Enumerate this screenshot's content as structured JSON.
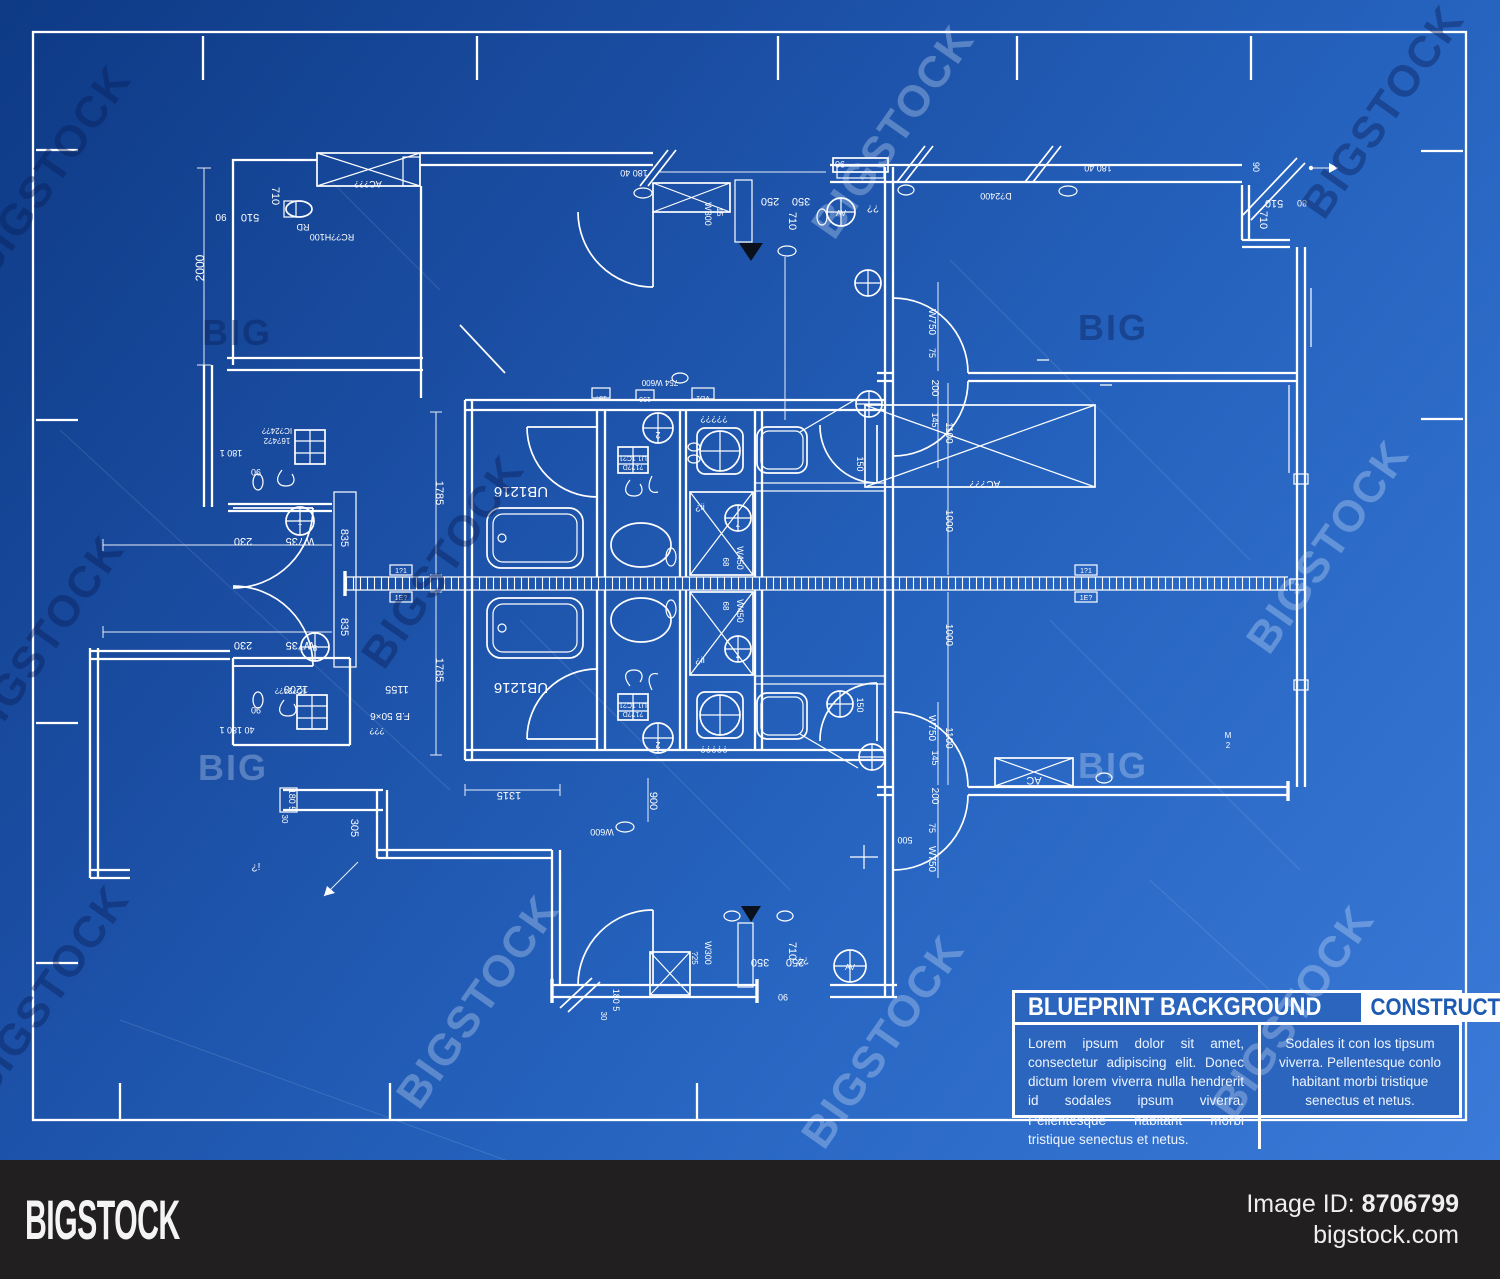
{
  "title_block": {
    "title": "BLUEPRINT BACKGROUND",
    "category": "CONSTRUCTION",
    "description": "Lorem ipsum dolor sit amet, consectetur adipiscing elit. Donec dictum lorem viverra nulla hendrerit id sodales ipsum viverra. Pellentesque habitant morbi tristique senectus et netus.",
    "category_description": "Sodales it con los tipsum viverra. Pellentesque conlo habitant morbi tristique senectus et netus."
  },
  "footer": {
    "logo": "BIGSTOCK",
    "image_id_label": "Image ID:",
    "image_id": "8706799",
    "website": "bigstock.com"
  },
  "colors": {
    "background_top": "#0e3a85",
    "background_bottom": "#3b7ad8",
    "line": "#ffffff",
    "panel_blue": "#2b65bd",
    "category_text": "#1d5ab2",
    "footer_bg": "#211f20",
    "marker_black": "#0b101d"
  },
  "watermarks": {
    "brand": "BIGSTOCK",
    "short": "BIG",
    "diagonal": [
      {
        "x": 62,
        "y": 180,
        "tone": "dark"
      },
      {
        "x": 905,
        "y": 140,
        "tone": "light"
      },
      {
        "x": 1395,
        "y": 120,
        "tone": "dark"
      },
      {
        "x": 55,
        "y": 650,
        "tone": "dark"
      },
      {
        "x": 455,
        "y": 570,
        "tone": "dark"
      },
      {
        "x": 1340,
        "y": 555,
        "tone": "light"
      },
      {
        "x": 60,
        "y": 1000,
        "tone": "dark"
      },
      {
        "x": 490,
        "y": 1010,
        "tone": "light"
      },
      {
        "x": 895,
        "y": 1050,
        "tone": "light"
      },
      {
        "x": 1305,
        "y": 1020,
        "tone": "light"
      }
    ],
    "horizontal": [
      {
        "x": 237,
        "y": 345,
        "tone": "dark"
      },
      {
        "x": 1113,
        "y": 340,
        "tone": "dark"
      },
      {
        "x": 233,
        "y": 780,
        "tone": "light"
      },
      {
        "x": 1113,
        "y": 778,
        "tone": "light"
      }
    ]
  },
  "plan_labels": [
    {
      "t": "2000",
      "x": 204,
      "y": 268,
      "r": -90,
      "s": 12
    },
    {
      "t": "710",
      "x": 272,
      "y": 196,
      "r": 90,
      "s": 11
    },
    {
      "t": "510",
      "x": 250,
      "y": 214,
      "r": 180,
      "s": 11
    },
    {
      "t": "90",
      "x": 221,
      "y": 214,
      "r": 180,
      "s": 10
    },
    {
      "t": "RD",
      "x": 303,
      "y": 224,
      "r": 180,
      "s": 9
    },
    {
      "t": "RC??H100",
      "x": 332,
      "y": 234,
      "r": 180,
      "s": 9
    },
    {
      "t": "AC???",
      "x": 368,
      "y": 181,
      "r": 180,
      "s": 9
    },
    {
      "t": "180 40",
      "x": 634,
      "y": 170,
      "r": 180,
      "s": 9
    },
    {
      "t": "W300",
      "x": 705,
      "y": 214,
      "r": 90,
      "s": 9
    },
    {
      "t": "15",
      "x": 717,
      "y": 212,
      "r": 90,
      "s": 8
    },
    {
      "t": "250",
      "x": 770,
      "y": 198,
      "r": 180,
      "s": 11
    },
    {
      "t": "350",
      "x": 801,
      "y": 198,
      "r": 180,
      "s": 11
    },
    {
      "t": "710",
      "x": 789,
      "y": 221,
      "r": 90,
      "s": 11
    },
    {
      "t": "90",
      "x": 840,
      "y": 161,
      "r": 180,
      "s": 9
    },
    {
      "t": "D?2400",
      "x": 996,
      "y": 193,
      "r": 180,
      "s": 9
    },
    {
      "t": "180 40",
      "x": 1098,
      "y": 165,
      "r": 180,
      "s": 9
    },
    {
      "t": "90",
      "x": 1253,
      "y": 167,
      "r": 90,
      "s": 9
    },
    {
      "t": "510",
      "x": 1274,
      "y": 200,
      "r": 180,
      "s": 11
    },
    {
      "t": "80",
      "x": 1302,
      "y": 200,
      "r": 180,
      "s": 9
    },
    {
      "t": "710",
      "x": 1260,
      "y": 220,
      "r": 90,
      "s": 11
    },
    {
      "t": "¿¿",
      "x": 873,
      "y": 211,
      "r": 0,
      "s": 10
    },
    {
      "t": "AV",
      "x": 841,
      "y": 216,
      "r": 0,
      "s": 8
    },
    {
      "t": "180 1",
      "x": 231,
      "y": 450,
      "r": 180,
      "s": 9
    },
    {
      "t": "90",
      "x": 256,
      "y": 469,
      "r": 180,
      "s": 9
    },
    {
      "t": "IC?24??",
      "x": 277,
      "y": 428,
      "r": 180,
      "s": 8
    },
    {
      "t": "16?4?2",
      "x": 277,
      "y": 438,
      "r": 180,
      "s": 8
    },
    {
      "t": "W735",
      "x": 300,
      "y": 538,
      "r": 180,
      "s": 11
    },
    {
      "t": "230",
      "x": 243,
      "y": 538,
      "r": 180,
      "s": 11
    },
    {
      "t": "W735",
      "x": 300,
      "y": 642,
      "r": 180,
      "s": 11
    },
    {
      "t": "230",
      "x": 243,
      "y": 642,
      "r": 180,
      "s": 11
    },
    {
      "t": "835",
      "x": 341,
      "y": 538,
      "r": 90,
      "s": 11
    },
    {
      "t": "835",
      "x": 341,
      "y": 627,
      "r": 90,
      "s": 11
    },
    {
      "t": "1",
      "x": 300,
      "y": 525,
      "r": 0,
      "s": 8
    },
    {
      "t": "3",
      "x": 315,
      "y": 651,
      "r": 0,
      "s": 8
    },
    {
      "t": "1200",
      "x": 296,
      "y": 686,
      "r": 180,
      "s": 11
    },
    {
      "t": "1155",
      "x": 397,
      "y": 686,
      "r": 180,
      "s": 11
    },
    {
      "t": "F.B 50×6",
      "x": 390,
      "y": 713,
      "r": 180,
      "s": 10
    },
    {
      "t": "???",
      "x": 377,
      "y": 728,
      "r": 180,
      "s": 9
    },
    {
      "t": "40 180 1",
      "x": 237,
      "y": 727,
      "r": 180,
      "s": 9
    },
    {
      "t": "90",
      "x": 256,
      "y": 707,
      "r": 180,
      "s": 9
    },
    {
      "t": "IC?24??",
      "x": 290,
      "y": 688,
      "r": 180,
      "s": 8
    },
    {
      "t": "180 5",
      "x": 289,
      "y": 800,
      "r": 90,
      "s": 9
    },
    {
      "t": "30",
      "x": 282,
      "y": 819,
      "r": 90,
      "s": 8
    },
    {
      "t": "305",
      "x": 351,
      "y": 828,
      "r": 90,
      "s": 11
    },
    {
      "t": "¿!",
      "x": 256,
      "y": 870,
      "r": 0,
      "s": 10
    },
    {
      "t": "1785",
      "x": 436,
      "y": 493,
      "r": 90,
      "s": 11
    },
    {
      "t": "1785",
      "x": 436,
      "y": 670,
      "r": 90,
      "s": 11
    },
    {
      "t": "UB1216",
      "x": 521,
      "y": 487,
      "r": 180,
      "s": 15
    },
    {
      "t": "UB1216",
      "x": 521,
      "y": 683,
      "r": 180,
      "s": 15
    },
    {
      "t": "15?",
      "x": 601,
      "y": 396,
      "r": 180,
      "s": 7
    },
    {
      "t": "190",
      "x": 645,
      "y": 397,
      "r": 180,
      "s": 7
    },
    {
      "t": "VD1",
      "x": 703,
      "y": 396,
      "r": 180,
      "s": 7
    },
    {
      "t": "754 W600",
      "x": 660,
      "y": 380,
      "r": 180,
      "s": 8
    },
    {
      "t": "2",
      "x": 658,
      "y": 432,
      "r": 180,
      "s": 9
    },
    {
      "t": "2",
      "x": 658,
      "y": 742,
      "r": 180,
      "s": 9
    },
    {
      "t": "U1 1C?1",
      "x": 633,
      "y": 456,
      "r": 180,
      "s": 7
    },
    {
      "t": "?1??D",
      "x": 633,
      "y": 465,
      "r": 180,
      "s": 7
    },
    {
      "t": "U1 1C?1",
      "x": 633,
      "y": 703,
      "r": 180,
      "s": 7
    },
    {
      "t": "?1??D",
      "x": 633,
      "y": 712,
      "r": 180,
      "s": 7
    },
    {
      "t": "¿¿¿¿¿",
      "x": 714,
      "y": 421,
      "r": 0,
      "s": 9
    },
    {
      "t": "¿¿¿¿¿",
      "x": 714,
      "y": 751,
      "r": 0,
      "s": 9
    },
    {
      "t": "¿ii",
      "x": 700,
      "y": 510,
      "r": 0,
      "s": 9
    },
    {
      "t": "¿ii",
      "x": 700,
      "y": 663,
      "r": 0,
      "s": 9
    },
    {
      "t": "7",
      "x": 738,
      "y": 521,
      "r": 180,
      "s": 8
    },
    {
      "t": "7",
      "x": 738,
      "y": 652,
      "r": 180,
      "s": 8
    },
    {
      "t": "W450",
      "x": 737,
      "y": 558,
      "r": 90,
      "s": 9
    },
    {
      "t": "68",
      "x": 723,
      "y": 562,
      "r": 90,
      "s": 8
    },
    {
      "t": "W450",
      "x": 737,
      "y": 611,
      "r": 90,
      "s": 9
    },
    {
      "t": "68",
      "x": 723,
      "y": 606,
      "r": 90,
      "s": 8
    },
    {
      "t": "150",
      "x": 857,
      "y": 464,
      "r": 90,
      "s": 9
    },
    {
      "t": "150",
      "x": 857,
      "y": 705,
      "r": 90,
      "s": 9
    },
    {
      "t": "1315",
      "x": 509,
      "y": 792,
      "r": 180,
      "s": 11
    },
    {
      "t": "900",
      "x": 650,
      "y": 801,
      "r": 90,
      "s": 11
    },
    {
      "t": "W600",
      "x": 602,
      "y": 829,
      "r": 180,
      "s": 9
    },
    {
      "t": "W300",
      "x": 705,
      "y": 953,
      "r": 90,
      "s": 9
    },
    {
      "t": "?25",
      "x": 692,
      "y": 958,
      "r": 90,
      "s": 8
    },
    {
      "t": "350",
      "x": 760,
      "y": 959,
      "r": 180,
      "s": 11
    },
    {
      "t": "250",
      "x": 795,
      "y": 959,
      "r": 180,
      "s": 11
    },
    {
      "t": "710",
      "x": 789,
      "y": 951,
      "r": 90,
      "s": 11
    },
    {
      "t": "90",
      "x": 783,
      "y": 994,
      "r": 180,
      "s": 9
    },
    {
      "t": "180 5",
      "x": 613,
      "y": 1000,
      "r": 90,
      "s": 9
    },
    {
      "t": "30",
      "x": 601,
      "y": 1016,
      "r": 90,
      "s": 8
    },
    {
      "t": "AV",
      "x": 850,
      "y": 970,
      "r": 0,
      "s": 8
    },
    {
      "t": "¿¿",
      "x": 803,
      "y": 963,
      "r": 0,
      "s": 10
    },
    {
      "t": "W750",
      "x": 929,
      "y": 322,
      "r": 90,
      "s": 10
    },
    {
      "t": "75",
      "x": 929,
      "y": 353,
      "r": 90,
      "s": 9
    },
    {
      "t": "200",
      "x": 932,
      "y": 388,
      "r": 90,
      "s": 10
    },
    {
      "t": "145",
      "x": 932,
      "y": 420,
      "r": 90,
      "s": 9
    },
    {
      "t": "1100",
      "x": 946,
      "y": 433,
      "r": 90,
      "s": 10
    },
    {
      "t": "1000",
      "x": 946,
      "y": 521,
      "r": 90,
      "s": 10
    },
    {
      "t": "1000",
      "x": 946,
      "y": 635,
      "r": 90,
      "s": 10
    },
    {
      "t": "W750",
      "x": 929,
      "y": 728,
      "r": 90,
      "s": 10
    },
    {
      "t": "145",
      "x": 932,
      "y": 758,
      "r": 90,
      "s": 9
    },
    {
      "t": "200",
      "x": 932,
      "y": 796,
      "r": 90,
      "s": 10
    },
    {
      "t": "75",
      "x": 929,
      "y": 828,
      "r": 90,
      "s": 9
    },
    {
      "t": "W750",
      "x": 929,
      "y": 859,
      "r": 90,
      "s": 10
    },
    {
      "t": "1100",
      "x": 946,
      "y": 738,
      "r": 90,
      "s": 10
    },
    {
      "t": "500",
      "x": 905,
      "y": 837,
      "r": 180,
      "s": 9
    },
    {
      "t": "AC",
      "x": 1034,
      "y": 777,
      "r": 180,
      "s": 11
    },
    {
      "t": "AC???",
      "x": 985,
      "y": 481,
      "r": 180,
      "s": 10
    },
    {
      "t": "1?1",
      "x": 401,
      "y": 573,
      "r": 0,
      "s": 7
    },
    {
      "t": "1E?",
      "x": 401,
      "y": 600,
      "r": 0,
      "s": 7
    },
    {
      "t": "1?1",
      "x": 1086,
      "y": 573,
      "r": 0,
      "s": 7
    },
    {
      "t": "1E?",
      "x": 1086,
      "y": 600,
      "r": 0,
      "s": 7
    },
    {
      "t": "?",
      "x": 1297,
      "y": 588,
      "r": 0,
      "s": 7
    },
    {
      "t": "M",
      "x": 1228,
      "y": 738,
      "r": 0,
      "s": 8
    },
    {
      "t": "2",
      "x": 1228,
      "y": 748,
      "r": 0,
      "s": 8
    }
  ]
}
